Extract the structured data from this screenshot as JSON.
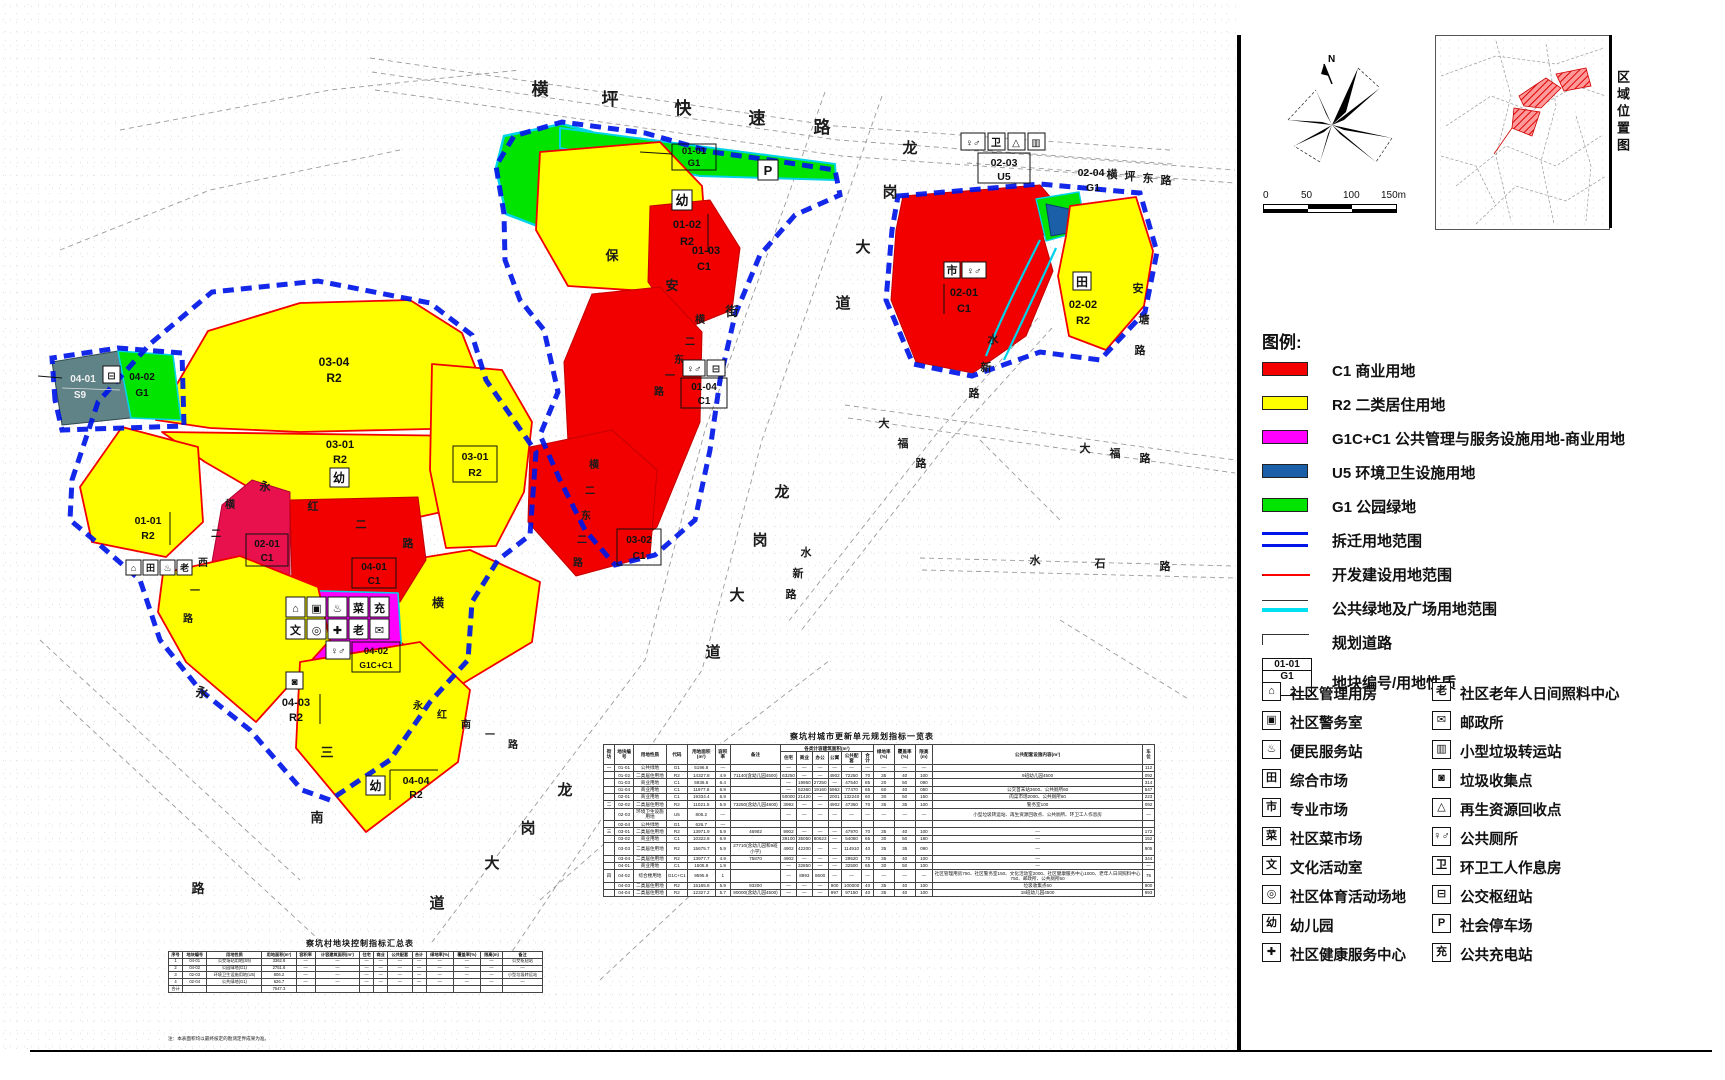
{
  "legend": {
    "title": "图例:",
    "items": [
      {
        "kind": "swatch",
        "color": "#f50000",
        "code": "C1",
        "label": "C1 商业用地"
      },
      {
        "kind": "swatch",
        "color": "#ffff00",
        "code": "R2",
        "label": "R2 二类居住用地"
      },
      {
        "kind": "swatch",
        "color": "#ff00ff",
        "code": "G1C+C1",
        "label": "G1C+C1 公共管理与服务设施用地-商业用地"
      },
      {
        "kind": "swatch",
        "color": "#1a5fa8",
        "code": "U5",
        "label": "U5 环境卫生设施用地"
      },
      {
        "kind": "swatch",
        "color": "#00e400",
        "code": "G1",
        "label": "G1 公园绿地"
      },
      {
        "kind": "line-blue",
        "color": "#0016e8",
        "label": "拆迁用地范围"
      },
      {
        "kind": "line-red",
        "color": "#ff0000",
        "label": "开发建设用地范围"
      },
      {
        "kind": "line-cyan",
        "color": "#00e0f0",
        "label": "公共绿地及广场用地范围"
      },
      {
        "kind": "line-road",
        "color": "#333333",
        "label": "规划道路"
      }
    ],
    "sample_box": {
      "code": "01-01",
      "use": "G1",
      "label": "地块编号/用地性质"
    }
  },
  "glyphs": {
    "mgmt": "⌂",
    "police": "▣",
    "conv": "♨",
    "market": "田",
    "pro": "市",
    "veg": "菜",
    "culture": "文",
    "sport": "◎",
    "kind": "幼",
    "health": "✚",
    "elder": "老",
    "post": "✉",
    "transfer": "▥",
    "collect": "◙",
    "recycle": "△",
    "toilet": "♀♂",
    "sanit": "卫",
    "bus": "⊟",
    "park": "P",
    "charge": "充"
  },
  "facilities": {
    "left": [
      {
        "glyph": "⌂",
        "label": "社区管理用房"
      },
      {
        "glyph": "▣",
        "label": "社区警务室"
      },
      {
        "glyph": "♨",
        "label": "便民服务站"
      },
      {
        "glyph": "田",
        "label": "综合市场"
      },
      {
        "glyph": "市",
        "label": "专业市场"
      },
      {
        "glyph": "菜",
        "label": "社区菜市场"
      },
      {
        "glyph": "文",
        "label": "文化活动室"
      },
      {
        "glyph": "◎",
        "label": "社区体育活动场地"
      },
      {
        "glyph": "幼",
        "label": "幼儿园"
      },
      {
        "glyph": "✚",
        "label": "社区健康服务中心"
      }
    ],
    "right": [
      {
        "glyph": "老",
        "label": "社区老年人日间照料中心"
      },
      {
        "glyph": "✉",
        "label": "邮政所"
      },
      {
        "glyph": "▥",
        "label": "小型垃圾转运站"
      },
      {
        "glyph": "◙",
        "label": "垃圾收集点"
      },
      {
        "glyph": "△",
        "label": "再生资源回收点"
      },
      {
        "glyph": "♀♂",
        "label": "公共厕所"
      },
      {
        "glyph": "卫",
        "label": "环卫工人作息房"
      },
      {
        "glyph": "⊟",
        "label": "公交枢纽站"
      },
      {
        "glyph": "P",
        "label": "社会停车场"
      },
      {
        "glyph": "充",
        "label": "公共充电站"
      }
    ]
  },
  "compass": {
    "north_label": "N"
  },
  "scale_bar": {
    "ticks": [
      "0",
      "50",
      "100",
      "150m"
    ]
  },
  "location_map": {
    "caption": "区域位置图"
  },
  "roads": [
    {
      "text": "横坪快速路",
      "pts": "540,95 610,105 683,114 757,124 822,133",
      "fs": 17
    },
    {
      "text": "横坪东路",
      "pts": "1112,178 1130,180 1148,182 1166,184",
      "fs": 11
    },
    {
      "text": "龙岗大道",
      "pts": "910,153 890,197 863,252 843,308",
      "fs": 15
    },
    {
      "text": "龙岗大道",
      "pts": "782,497 760,545 737,600 713,657",
      "fs": 15
    },
    {
      "text": "龙岗大道",
      "pts": "565,795 528,833 492,868 437,908",
      "fs": 15
    },
    {
      "text": "保安街",
      "pts": "612,260 672,290 732,316",
      "fs": 13
    },
    {
      "text": "横二东一路",
      "pts": "700,323 690,345 679,363 670,379 659,395",
      "fs": 10
    },
    {
      "text": "横二东二路",
      "pts": "594,468 590,494 586,519 582,543 578,566",
      "fs": 10
    },
    {
      "text": "安塘路",
      "pts": "1138,292 1144,323 1140,354",
      "fs": 11
    },
    {
      "text": "水新路",
      "pts": "993,343 986,371 974,397",
      "fs": 11
    },
    {
      "text": "水新路",
      "pts": "806,556 798,577 791,598",
      "fs": 11
    },
    {
      "text": "水石路",
      "pts": "1035,564 1100,567 1165,570",
      "fs": 11
    },
    {
      "text": "大福路",
      "pts": "884,427 903,447 921,467",
      "fs": 11
    },
    {
      "text": "大福路",
      "pts": "1085,452 1115,457 1145,462",
      "fs": 11
    },
    {
      "text": "横二西一路",
      "pts": "230,508 216,537 203,566 195,594 188,622",
      "fs": 10
    },
    {
      "text": "永红二路",
      "pts": "265,490 313,510 361,528 408,547",
      "fs": 11
    },
    {
      "text": "永红南一路",
      "pts": "418,709 442,718 466,728 490,738 513,748",
      "fs": 10
    },
    {
      "text": "三",
      "pts": "327,757",
      "fs": 13
    },
    {
      "text": "南",
      "pts": "317,822",
      "fs": 13
    },
    {
      "text": "永",
      "pts": "202,697",
      "fs": 13
    },
    {
      "text": "路",
      "pts": "198,893",
      "fs": 13
    },
    {
      "text": "横",
      "pts": "438,607",
      "fs": 12
    }
  ],
  "plots": {
    "n0101": {
      "id": "01-01",
      "use": "G1"
    },
    "n0102": {
      "id": "01-02",
      "use": "R2"
    },
    "n0103": {
      "id": "01-03",
      "use": "C1"
    },
    "n0104": {
      "id": "01-04",
      "use": "C1"
    },
    "e0201": {
      "id": "02-01",
      "use": "C1"
    },
    "e0202": {
      "id": "02-02",
      "use": "R2"
    },
    "e0203": {
      "id": "02-03",
      "use": "U5"
    },
    "e0204": {
      "id": "02-04",
      "use": "G1"
    },
    "m0301e": {
      "id": "03-01",
      "use": "R2"
    },
    "m0301w": {
      "id": "03-01",
      "use": "R2"
    },
    "m0302": {
      "id": "03-02",
      "use": "C1"
    },
    "m0303": {
      "id": "03-03",
      "use": "R2"
    },
    "m0304": {
      "id": "03-04",
      "use": "R2"
    },
    "w0101": {
      "id": "01-01",
      "use": "R2"
    },
    "w0201": {
      "id": "02-01",
      "use": "C1"
    },
    "s0401": {
      "id": "04-01",
      "use": "C1"
    },
    "s0402": {
      "id": "04-02",
      "use": "G1C+C1"
    },
    "s0403": {
      "id": "04-03",
      "use": "R2"
    },
    "s0404": {
      "id": "04-04",
      "use": "R2"
    },
    "x0401": {
      "id": "04-01",
      "use": "S9"
    },
    "x0402": {
      "id": "04-02",
      "use": "G1"
    }
  },
  "tables": {
    "main": {
      "title": "察坑村城市更新单元规划指标一览表",
      "group": {
        "label": "各类计容建筑面积(m²)",
        "start": 7,
        "span": 6
      },
      "columns": [
        "街坊",
        "地块编号",
        "用地性质",
        "代码",
        "用地面积(m²)",
        "容积率",
        "备注",
        "住宅",
        "商业",
        "办公",
        "公寓",
        "公共配套",
        "合计",
        "绿地率(%)",
        "覆盖率(%)",
        "限高(m)",
        "公共配套设施内容(m²)",
        "车位"
      ],
      "rows": [
        [
          "一",
          "01-01",
          "公共绿地",
          "G1",
          "5196.8",
          "—",
          "",
          "—",
          "—",
          "—",
          "—",
          "—",
          "—",
          "—",
          "—",
          "—",
          "",
          "112"
        ],
        [
          "",
          "01-02",
          "二类居住用地",
          "R2",
          "14327.8",
          "4.9",
          "71140(含幼儿园4500)",
          "63250",
          "—",
          "—",
          "4902",
          "72250",
          "70",
          "35",
          "40",
          "100",
          "9班幼儿园4500",
          "092"
        ],
        [
          "",
          "01-03",
          "商业用地",
          "C1",
          "5936.6",
          "6.4",
          "",
          "—",
          "19950",
          "27250",
          "—",
          "47540",
          "85",
          "20",
          "50",
          "090",
          "",
          "314"
        ],
        [
          "",
          "01-04",
          "商业用地",
          "C1",
          "11977.8",
          "6.9",
          "",
          "—",
          "52360",
          "19160",
          "5962",
          "77470",
          "65",
          "60",
          "40",
          "050",
          "公交首末站3600、公共厕所60",
          "547"
        ],
        [
          "",
          "02-01",
          "商业用地",
          "C1",
          "19334.4",
          "6.9",
          "",
          "50000",
          "21420",
          "—",
          "2001",
          "132240",
          "60",
          "30",
          "50",
          "150",
          "肉菜市场2000、公共厕所60",
          "223"
        ],
        [
          "二",
          "02-02",
          "二类居住用地",
          "R2",
          "11021.5",
          "5.9",
          "73250(含幼儿园4800)",
          "3992",
          "—",
          "—",
          "4902",
          "47360",
          "70",
          "35",
          "35",
          "100",
          "警务室100",
          "092"
        ],
        [
          "",
          "02-03",
          "环境卫生设施用地",
          "U5",
          "806.2",
          "—",
          "",
          "—",
          "—",
          "—",
          "—",
          "—",
          "—",
          "—",
          "—",
          "—",
          "小型垃圾转运站、再生资源回收点、公共厕所、环卫工人作息房",
          "—"
        ],
        [
          "",
          "02-04",
          "公共绿地",
          "G1",
          "626.7",
          "—",
          "",
          "",
          "",
          "",
          "",
          "",
          "",
          "",
          "",
          "",
          "",
          ""
        ],
        [
          "三",
          "03-01",
          "二类居住用地",
          "R2",
          "13971.9",
          "5.9",
          "46902",
          "9902",
          "—",
          "—",
          "—",
          "47970",
          "70",
          "35",
          "40",
          "100",
          "—",
          "172"
        ],
        [
          "",
          "03-02",
          "商业用地",
          "C1",
          "10322.8",
          "6.9",
          "",
          "39100",
          "35050",
          "80623",
          "—",
          "54080",
          "65",
          "30",
          "50",
          "180",
          "—",
          "152"
        ],
        [
          "",
          "03-03",
          "二类居住用地",
          "R2",
          "15675.7",
          "5.9",
          "27710(含幼儿园和9班小学)",
          "4902",
          "42200",
          "—",
          "—",
          "114910",
          "40",
          "35",
          "35",
          "090",
          "—",
          "905"
        ],
        [
          "",
          "03-04",
          "二类居住用地",
          "R2",
          "13977.7",
          "4.9",
          "75870",
          "4902",
          "—",
          "—",
          "—",
          "29520",
          "70",
          "35",
          "40",
          "100",
          "—",
          "344"
        ],
        [
          "",
          "04-01",
          "商业用地",
          "C1",
          "1505.9",
          "1.9",
          "",
          "—",
          "32850",
          "—",
          "—",
          "32500",
          "65",
          "30",
          "50",
          "100",
          "—",
          "—"
        ],
        [
          "四",
          "04-02",
          "综合楼用地",
          "G1C+C1",
          "9595.9",
          "1",
          "",
          "—",
          "8993",
          "8600",
          "—",
          "—",
          "—",
          "—",
          "—",
          "—",
          "社区管理用房750、社区警务室150、文化活动室2000、社区健康服务中心1000、老年人日间照料中心750、邮政所、公共厕所60",
          "75"
        ],
        [
          "",
          "04-03",
          "二类居住用地",
          "R2",
          "15165.8",
          "5.9",
          "93200",
          "—",
          "—",
          "—",
          "900",
          "100000",
          "40",
          "35",
          "40",
          "100",
          "垃圾收集点60",
          "900"
        ],
        [
          "",
          "04-04",
          "二类居住用地",
          "R2",
          "12327.2",
          "5.7",
          "90000(含幼儿园4500)",
          "—",
          "—",
          "—",
          "997",
          "97150",
          "40",
          "35",
          "40",
          "100",
          "18班幼儿园4500",
          "993"
        ]
      ]
    },
    "summary": {
      "title": "察坑村地块控制指标汇总表",
      "columns": [
        "序号",
        "地块编号",
        "用地性质",
        "用地面积(m²)",
        "容积率",
        "计容建筑面积(m²)",
        "住宅",
        "商业",
        "公共配套",
        "合计",
        "绿地率(%)",
        "覆盖率(%)",
        "限高(m)",
        "备注"
      ],
      "rows": [
        [
          "1",
          "04-01",
          "公交场站用地(S9)",
          "3362.8",
          "—",
          "—",
          "—",
          "—",
          "—",
          "—",
          "—",
          "—",
          "—",
          "公交枢纽站"
        ],
        [
          "2",
          "04-02",
          "公园绿地(G1)",
          "2751.6",
          "—",
          "—",
          "—",
          "—",
          "—",
          "—",
          "—",
          "—",
          "—",
          "—"
        ],
        [
          "3",
          "02-03",
          "环境卫生设施用地(U5)",
          "806.2",
          "—",
          "—",
          "—",
          "—",
          "—",
          "—",
          "—",
          "—",
          "—",
          "小型垃圾转运站"
        ],
        [
          "4",
          "02-04",
          "公共绿地(G1)",
          "626.7",
          "—",
          "—",
          "—",
          "—",
          "—",
          "—",
          "—",
          "—",
          "—",
          "—"
        ],
        [
          "合计",
          "",
          "",
          "7547.3",
          "",
          "",
          "",
          "",
          "",
          "",
          "",
          "",
          "",
          ""
        ]
      ],
      "note": "注：本表面积均以最终核定的勘测定界成果为准。"
    }
  }
}
